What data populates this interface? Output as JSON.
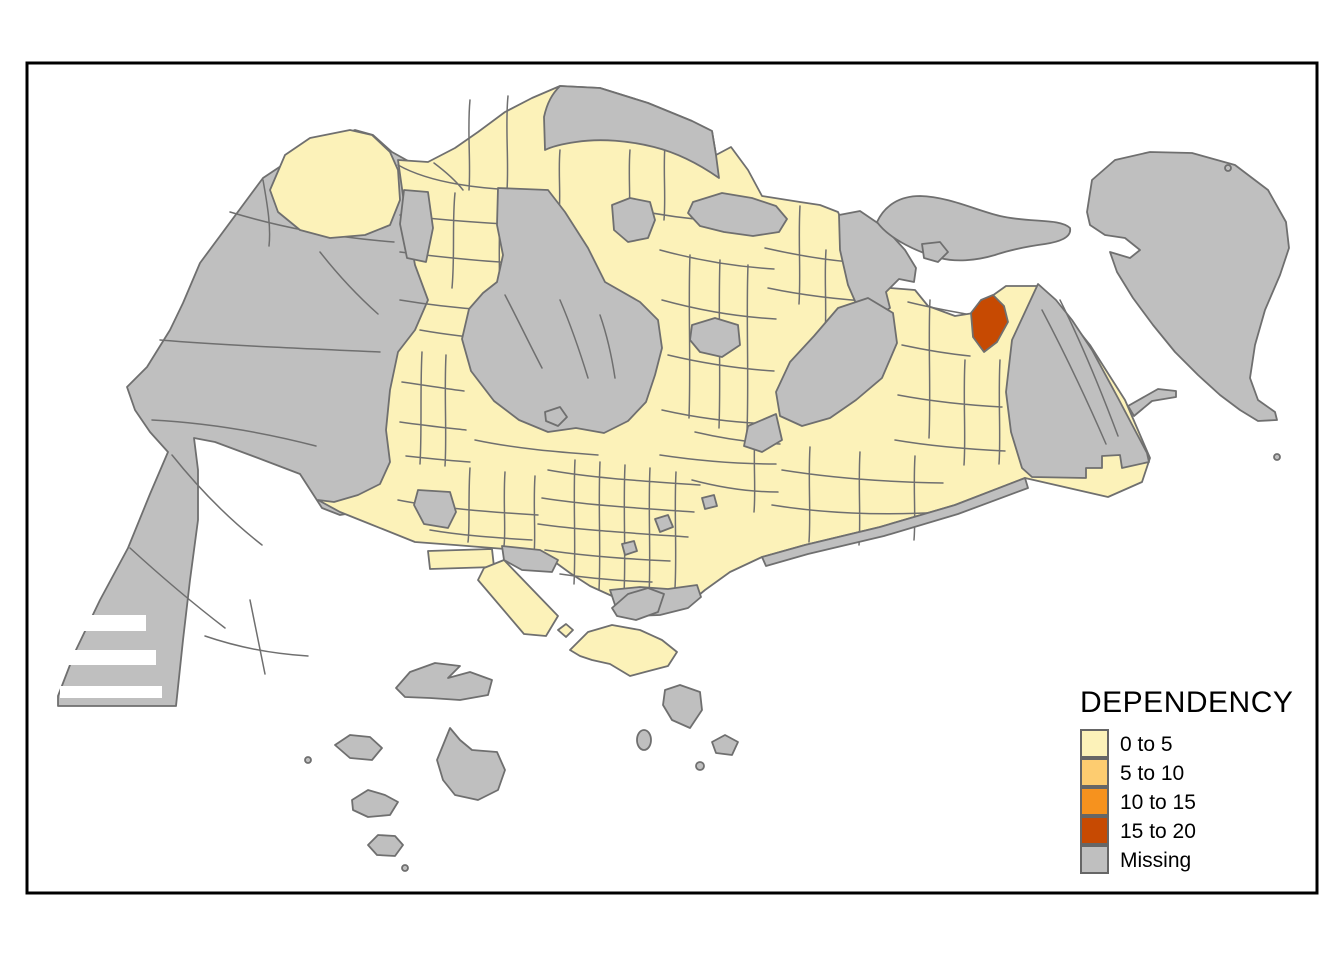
{
  "figure": {
    "type": "choropleth-map",
    "variable": "DEPENDENCY"
  },
  "legend": {
    "title": "DEPENDENCY",
    "items": [
      {
        "label": "0 to 5",
        "color_key": "class_0_5",
        "color": "#FCF2B9"
      },
      {
        "label": "5 to 10",
        "color_key": "class_5_10",
        "color": "#FDCC70"
      },
      {
        "label": "10 to 15",
        "color_key": "class_10_15",
        "color": "#F6921E"
      },
      {
        "label": "15 to 20",
        "color_key": "class_15_20",
        "color": "#C74A02"
      },
      {
        "label": "Missing",
        "color_key": "missing",
        "color": "#BFBFBF"
      }
    ]
  },
  "colors": {
    "background": "#FFFFFF",
    "frame": "#000000",
    "boundary": "#6F6F6F",
    "class_0_5": "#FCF2B9",
    "class_5_10": "#FDCC70",
    "class_10_15": "#F6921E",
    "class_15_20": "#C74A02",
    "missing": "#BFBFBF"
  },
  "map_summary": {
    "classes_present_on_map": [
      "0 to 5",
      "15 to 20",
      "Missing"
    ],
    "highlighted_zones_15_to_20": 1
  }
}
